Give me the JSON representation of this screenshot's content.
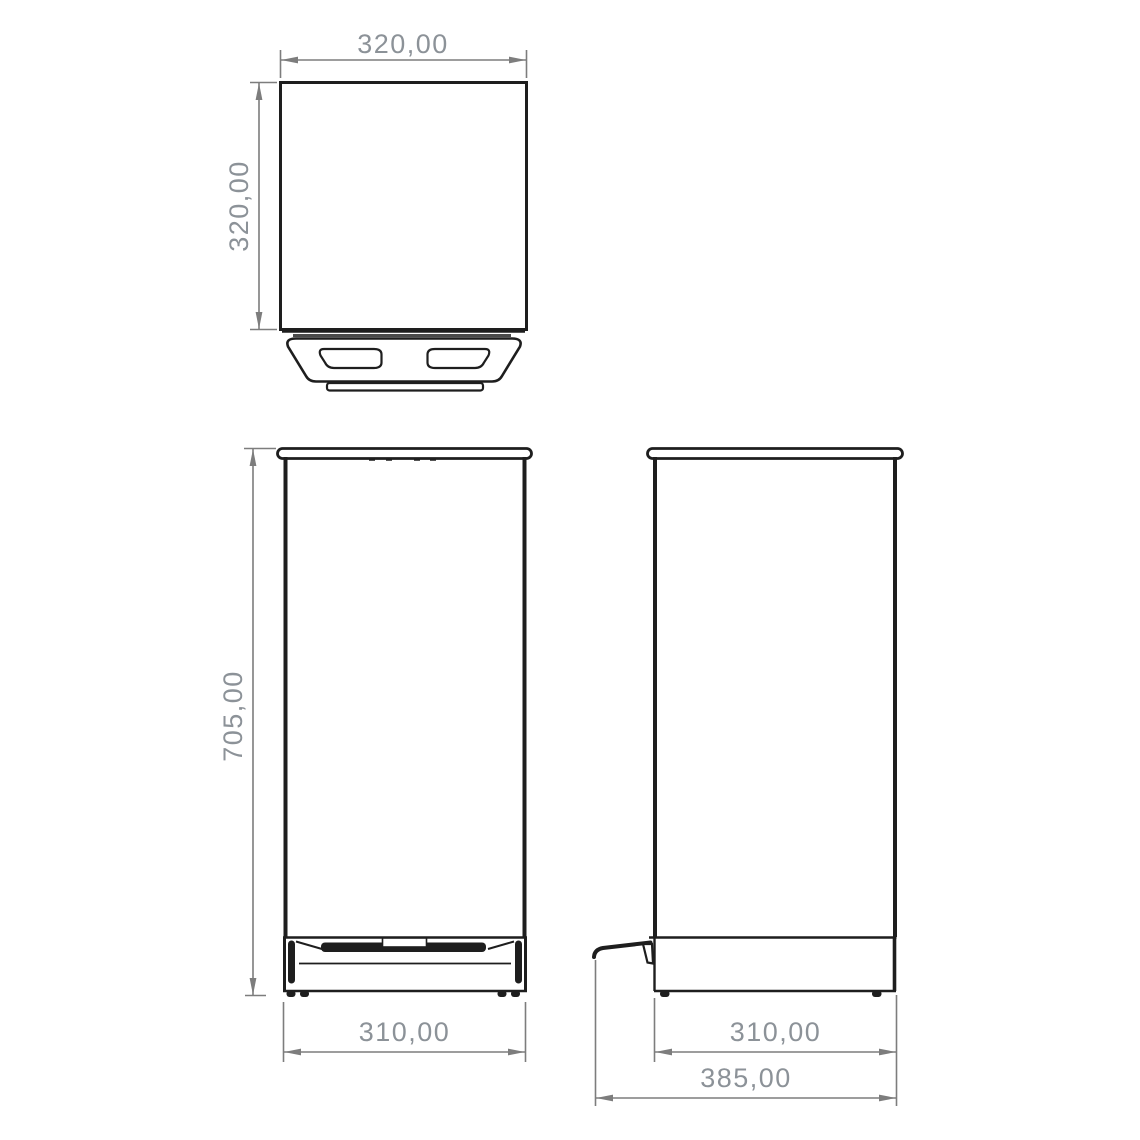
{
  "colors": {
    "background": "#ffffff",
    "line": "#1e1e1e",
    "dimension_line": "#7d7d7d",
    "dimension_text": "#8c9298"
  },
  "views": {
    "top": {
      "width_label": "320,00",
      "depth_label": "320,00"
    },
    "front": {
      "height_label": "705,00",
      "width_label": "310,00"
    },
    "side": {
      "body_depth_label": "310,00",
      "overall_depth_label": "385,00"
    }
  }
}
